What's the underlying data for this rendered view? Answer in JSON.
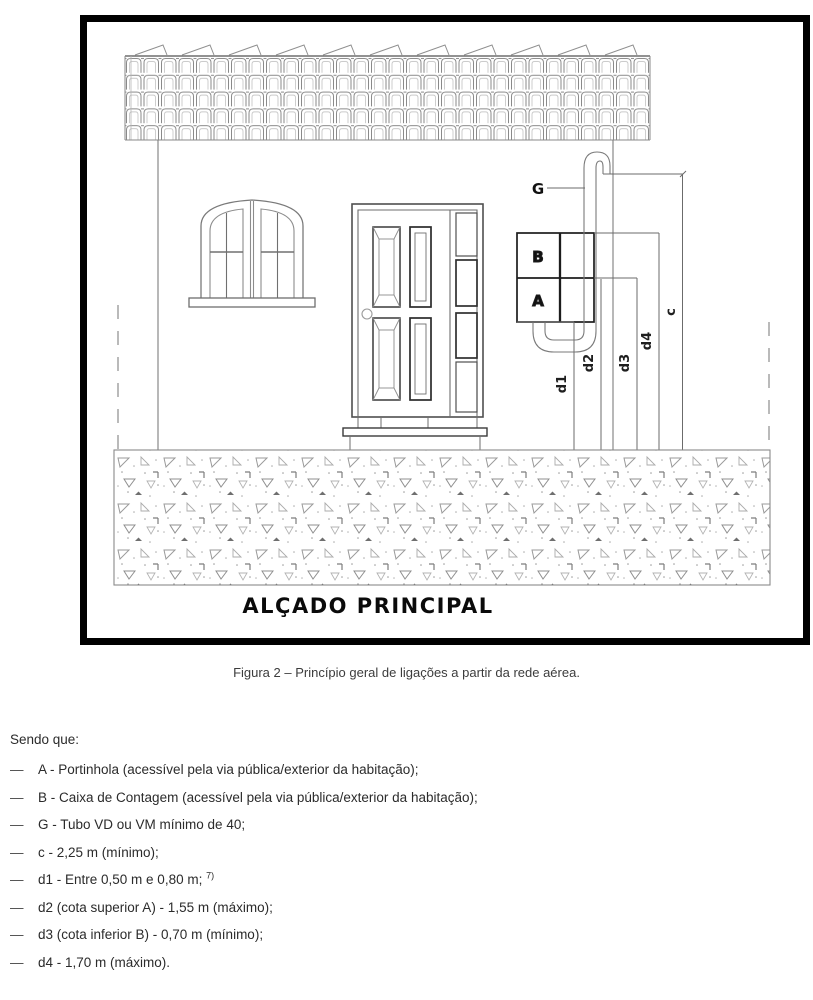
{
  "figure": {
    "title": "ALÇADO PRINCIPAL",
    "labels": {
      "g": "G",
      "b": "B",
      "a": "A",
      "c": "c",
      "d1": "d1",
      "d2": "d2",
      "d3": "d3",
      "d4": "d4"
    }
  },
  "caption": "Figura 2 – Princípio geral de ligações a partir da rede aérea.",
  "legend": {
    "intro": "Sendo que:",
    "dash": "—",
    "items": [
      {
        "text": "A - Portinhola (acessível pela via pública/exterior da habitação);"
      },
      {
        "text": "B - Caixa de Contagem (acessível pela via pública/exterior da habitação);"
      },
      {
        "text": "G - Tubo VD ou VM mínimo de 40;"
      },
      {
        "text": "c - 2,25 m (mínimo);"
      },
      {
        "text": "d1 - Entre 0,50 m e 0,80 m; ",
        "sup": "7)"
      },
      {
        "text": "d2 (cota superior A) - 1,55 m (máximo);"
      },
      {
        "text": "d3 (cota inferior B) - 0,70 m (mínimo);"
      },
      {
        "text": "d4 - 1,70 m (máximo)."
      }
    ]
  },
  "colors": {
    "frame": "#000000",
    "drawing_line": "#6a6a6a",
    "dark_line": "#2e2e2e",
    "hatch": "#9a9a9a"
  }
}
